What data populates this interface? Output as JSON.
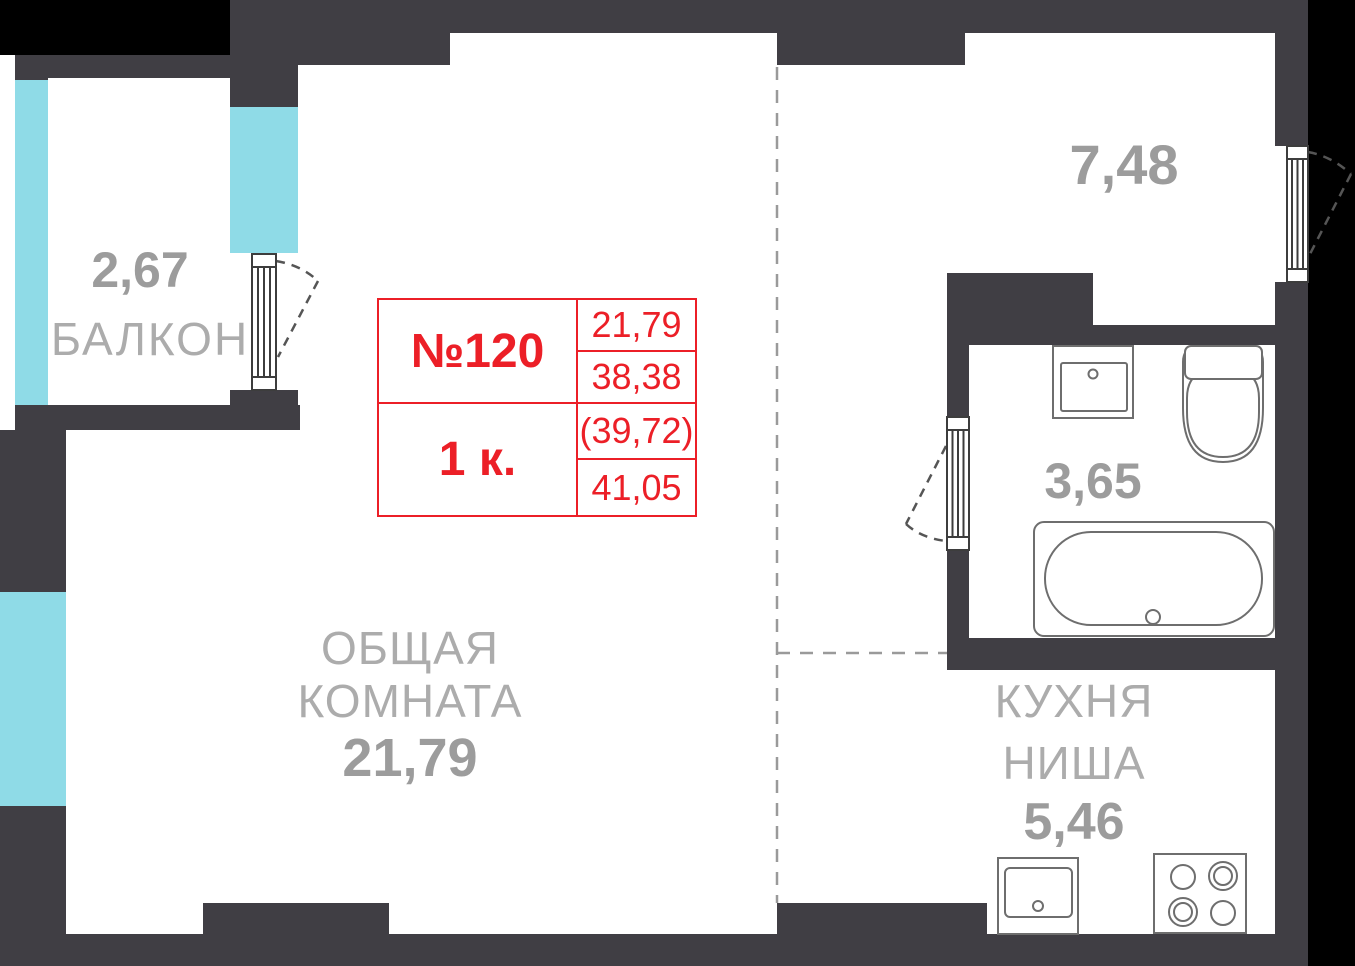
{
  "plan": {
    "unit": {
      "number": "№120",
      "rooms": "1 к.",
      "areas": {
        "living": "21,79",
        "usable": "38,38",
        "reduced": "(39,72)",
        "total": "41,05"
      }
    },
    "rooms": {
      "balcony": {
        "name": "БАЛКОН",
        "area": "2,67"
      },
      "living_room": {
        "name_line1": "ОБЩАЯ",
        "name_line2": "КОМНАТА",
        "area": "21,79"
      },
      "hall": {
        "area": "7,48"
      },
      "bathroom": {
        "area": "3,65"
      },
      "kitchen_niche": {
        "name_line1": "КУХНЯ",
        "name_line2": "НИША",
        "area": "5,46"
      }
    },
    "colors": {
      "wall": "#403e44",
      "outside": "#000000",
      "window": "#8fdbe7",
      "accent": "#ec1f27",
      "label": "#acacac",
      "number": "#9c9c9c",
      "fixture": "#6e6e6e",
      "door": "#3d3d3d",
      "swing": "#555555",
      "zone": "#9a9a9a"
    }
  }
}
